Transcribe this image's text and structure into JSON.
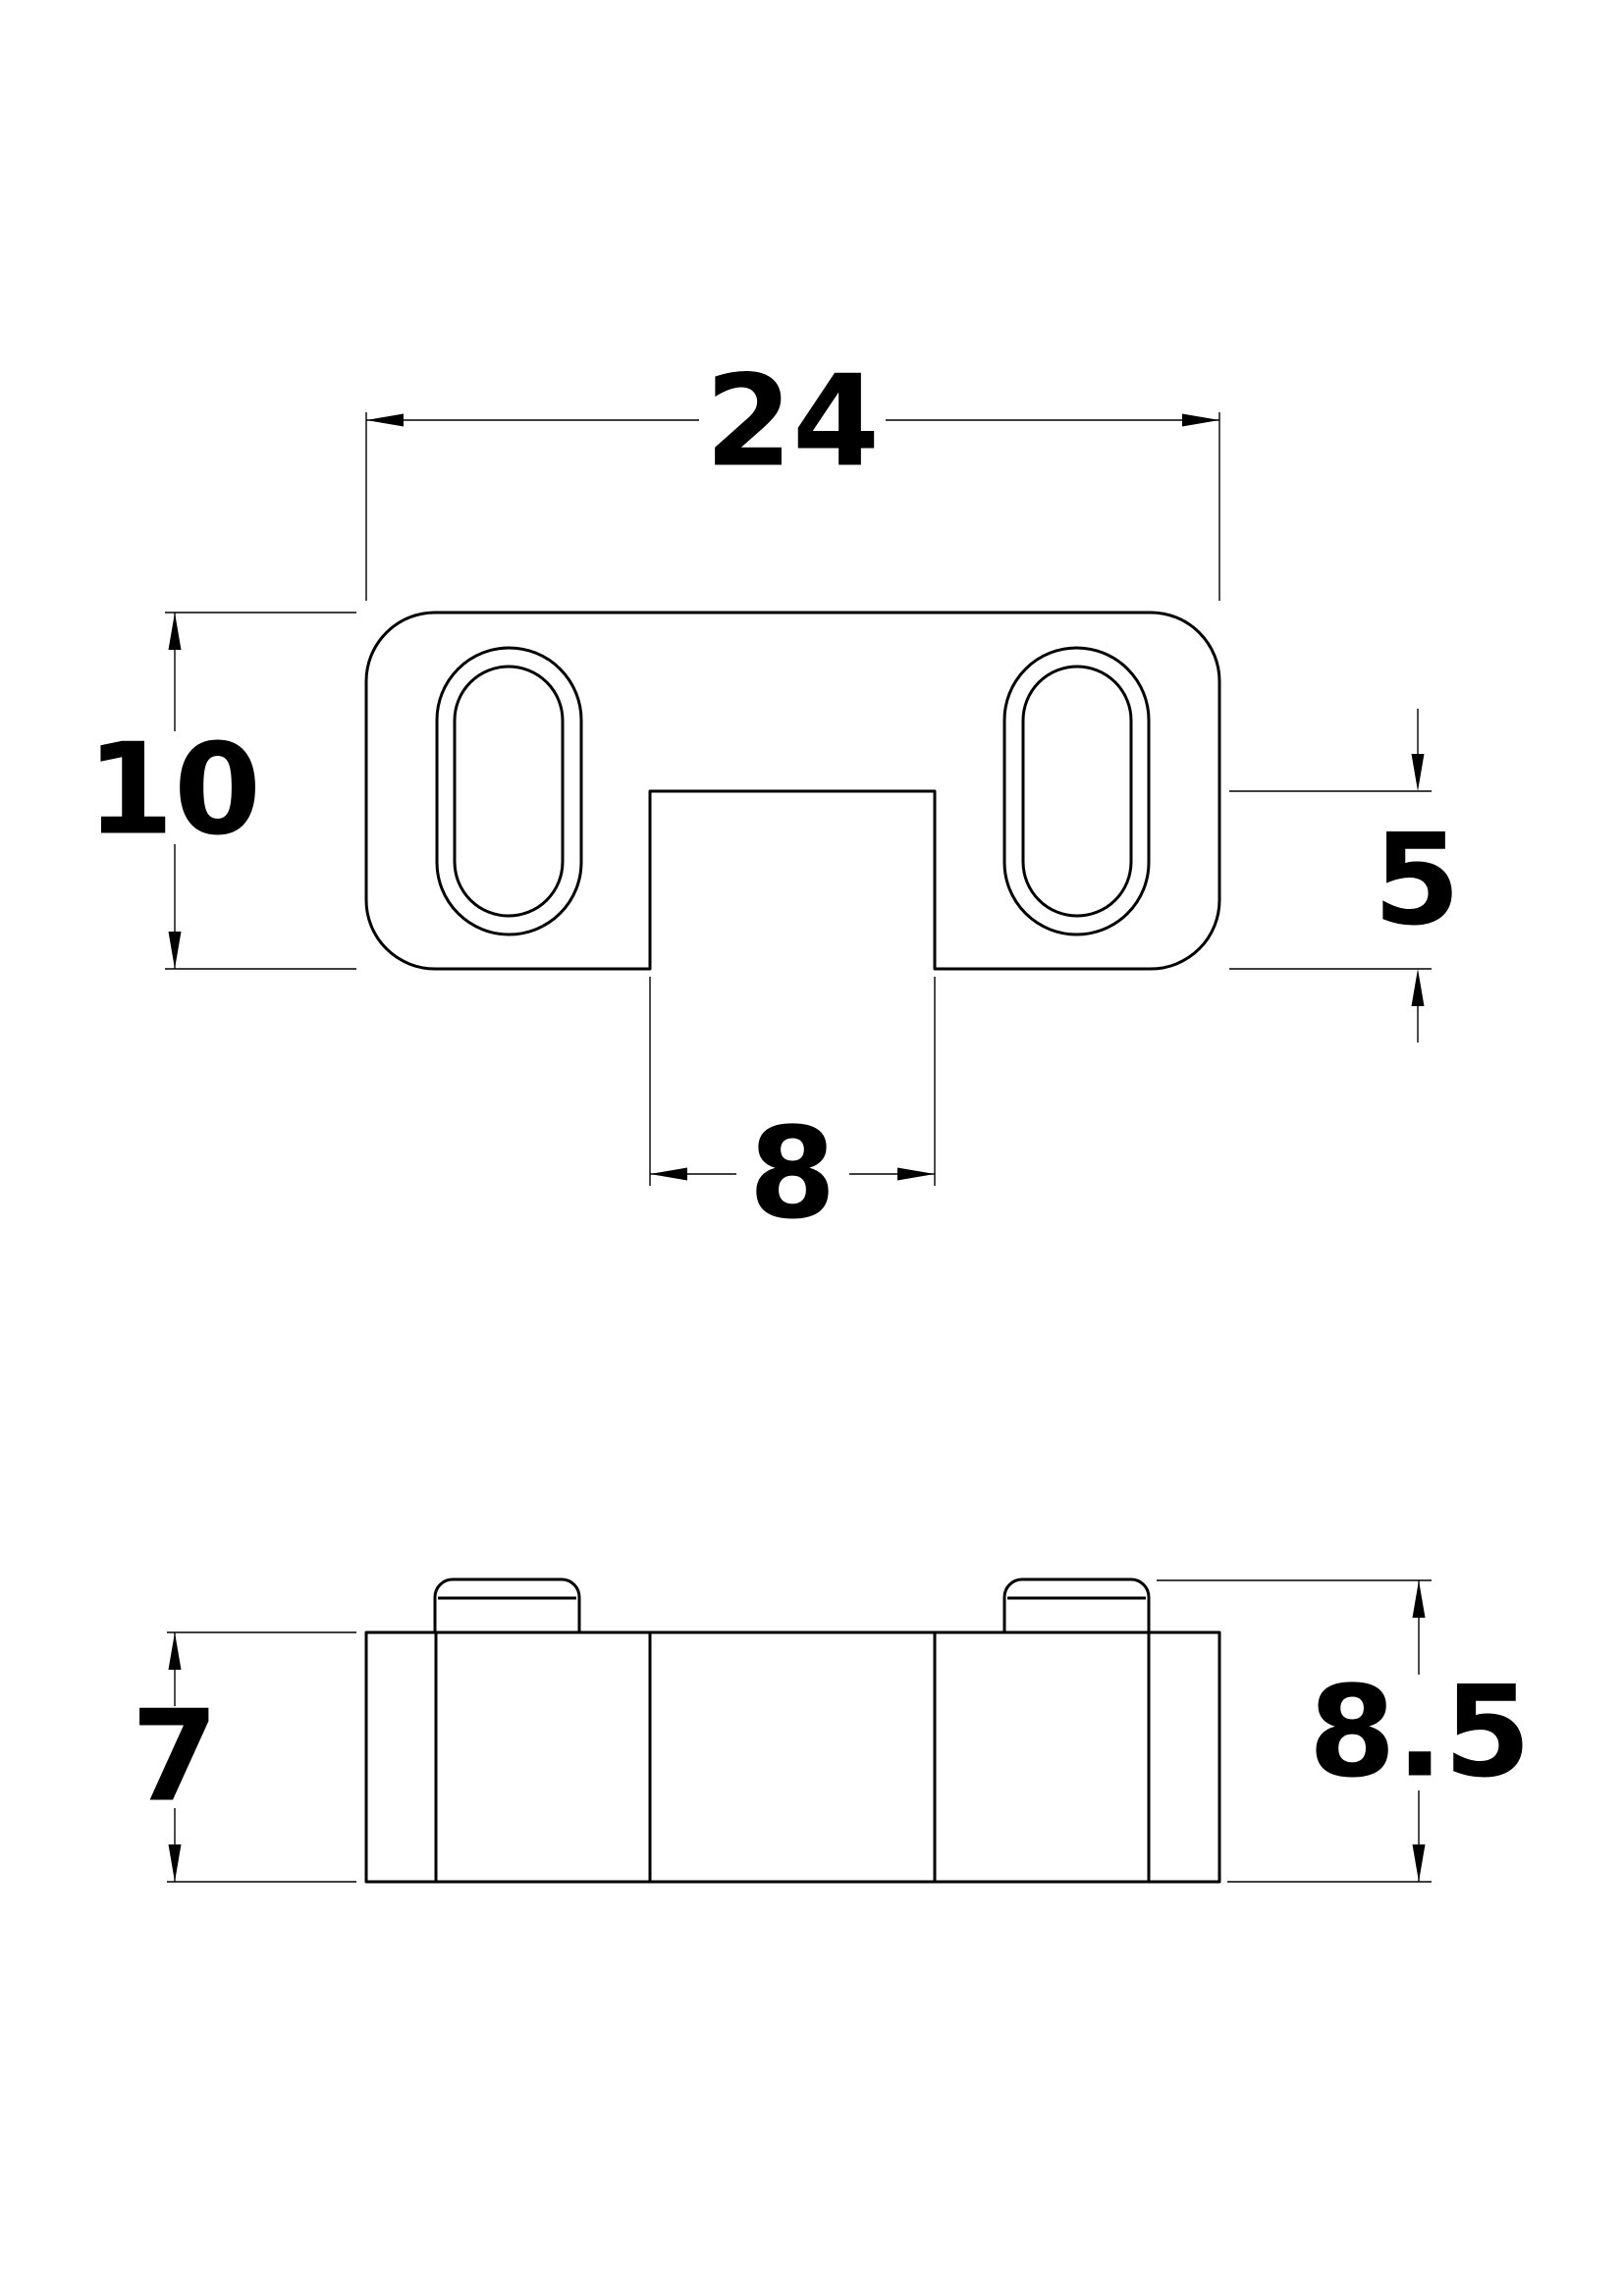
{
  "background_color": "#ffffff",
  "line_color": "#000000",
  "top_view": {
    "width_label": "24",
    "height_label": "10",
    "notch_depth_label": "5",
    "notch_width_label": "8"
  },
  "side_view": {
    "body_height_label": "7",
    "overall_height_label": "8.5"
  }
}
